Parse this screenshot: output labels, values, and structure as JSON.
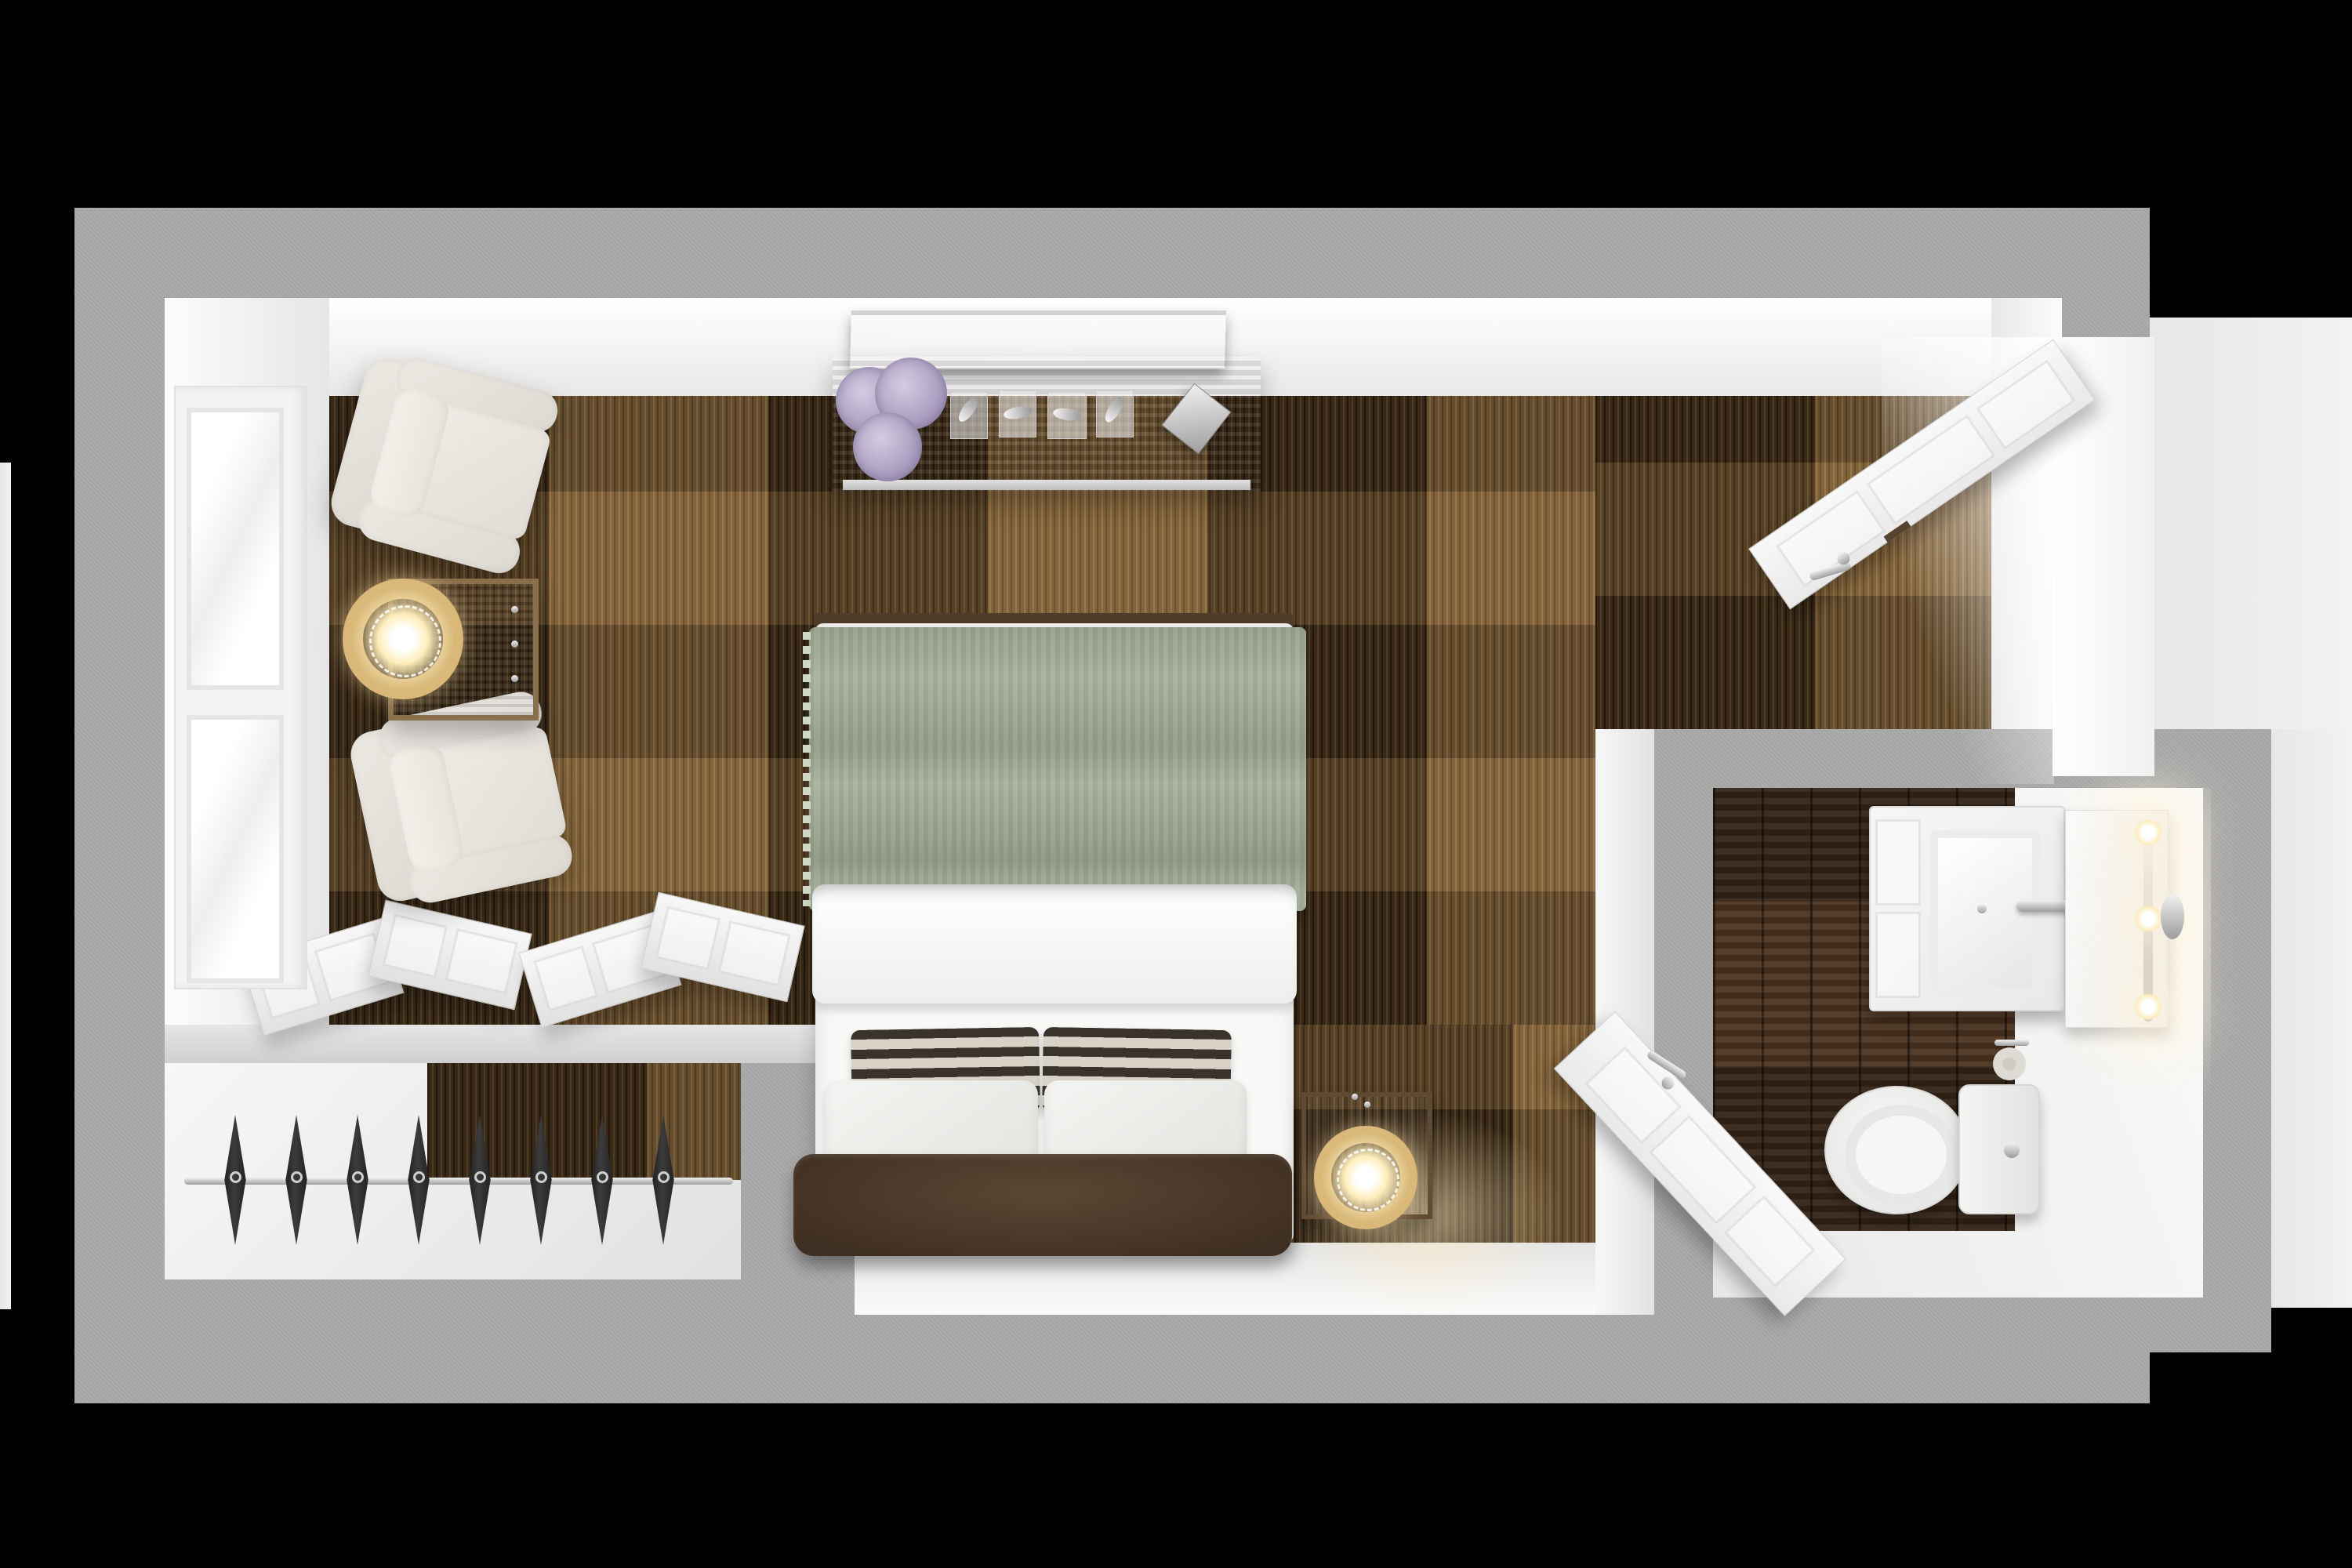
{
  "scene": {
    "label": "Top-down 3D rendered floor plan of a hotel guest room with bedroom, closet and en-suite bathroom",
    "background": "#000000"
  },
  "palette": {
    "outer_wall_gray": "#a9a9a9",
    "inner_wall_white": "#f5f5f5",
    "floor_white": "#ebebeb",
    "exterior_walkway_white": "#efefef",
    "carpet_base_brown": "#5a4124",
    "carpet_dark_brown": "#38281a",
    "carpet_light_tan": "#b28e58",
    "bathroom_wood_floor": "#46301f",
    "console_wood": "#8f7356",
    "side_table_wood": "#b39a70",
    "nightstand_crate_wood": "#7d6244",
    "bed_linen_white": "#f7f7f6",
    "throw_sage_green": "#a9b29d",
    "pillow_stripe_dark": "#3a332c",
    "pillow_stripe_cream": "#d9d2c6",
    "headboard_bench_leather": "#4e3d2e",
    "armchair_cream": "#e9e6e0",
    "lamp_ring_gold": "#d9b87a",
    "lamp_glow_warm": "#fff3d2",
    "chrome_metal": "#c9c9c9",
    "hanger_black": "#262626",
    "door_white": "#f4f4f4",
    "tv_black": "#141414",
    "hydrangea_lavender": "#b3a9c6",
    "leaf_green": "#5c7a4a"
  },
  "labels": {
    "floorplan": "guest room floor plan render",
    "exterior_walkway": "exterior walkway / hallway floor",
    "bedroom": "bedroom with brown patchwork carpet",
    "window": "double casement window in left wall",
    "armchair_top": "cream upholstered armchair (upper)",
    "armchair_bottom": "cream upholstered armchair (lower)",
    "side_table": "wooden side table with three drawers",
    "side_table_lamp": "gold ring table lamp (lit)",
    "media_console": "wood media console against top wall",
    "tv": "wall flat-screen TV above console",
    "flowers": "lavender hydrangea arrangement",
    "sculptures": "four silver bird figurines on stands",
    "decor_box": "silver decor box",
    "bed": "double bed",
    "sage_throw": "sage green throw across foot of bed",
    "duvet": "folded white duvet",
    "striped_pillow_left": "black and cream striped accent pillow (left)",
    "striped_pillow_right": "black and cream striped accent pillow (right)",
    "white_pillow_left": "white pillow (left)",
    "white_pillow_right": "white pillow (right)",
    "headboard_bench": "dark leather headboard cushion",
    "nightstand": "rustic wood crate nightstand",
    "nightstand_lamp": "gold ring accent lamp (lit)",
    "closet": "open closet alcove",
    "closet_rod": "chrome closet hanging rod",
    "closet_hanger": "black clothes hanger",
    "bifold_doors_left": "open white bifold closet doors (left pair)",
    "bifold_doors_right": "open white bifold closet doors (right pair)",
    "entry_door": "white entry door swung open",
    "entry_doorway": "entry doorway opening with light",
    "vestibule_wall": "partition wall between bedroom and bathroom",
    "bathroom": "en-suite bathroom with dark wood floor",
    "vanity": "white vanity cabinet with sink",
    "sink": "rectangular basin",
    "faucet": "chrome faucet",
    "mirror": "vanity mirror",
    "mirror_lights": "three lit vanity globe lights",
    "sconce": "chrome wall sconce",
    "toilet": "toilet with tank",
    "toilet_paper": "toilet paper holder",
    "bathroom_door": "white bathroom door swung open"
  },
  "counts": {
    "closet_hangers": 8,
    "mirror_lights": 3,
    "silver_sculptures": 4,
    "flower_clusters": 3,
    "bifold_door_sets": 2,
    "window_sashes": 2,
    "armchairs": 2,
    "ring_lamps": 2
  }
}
